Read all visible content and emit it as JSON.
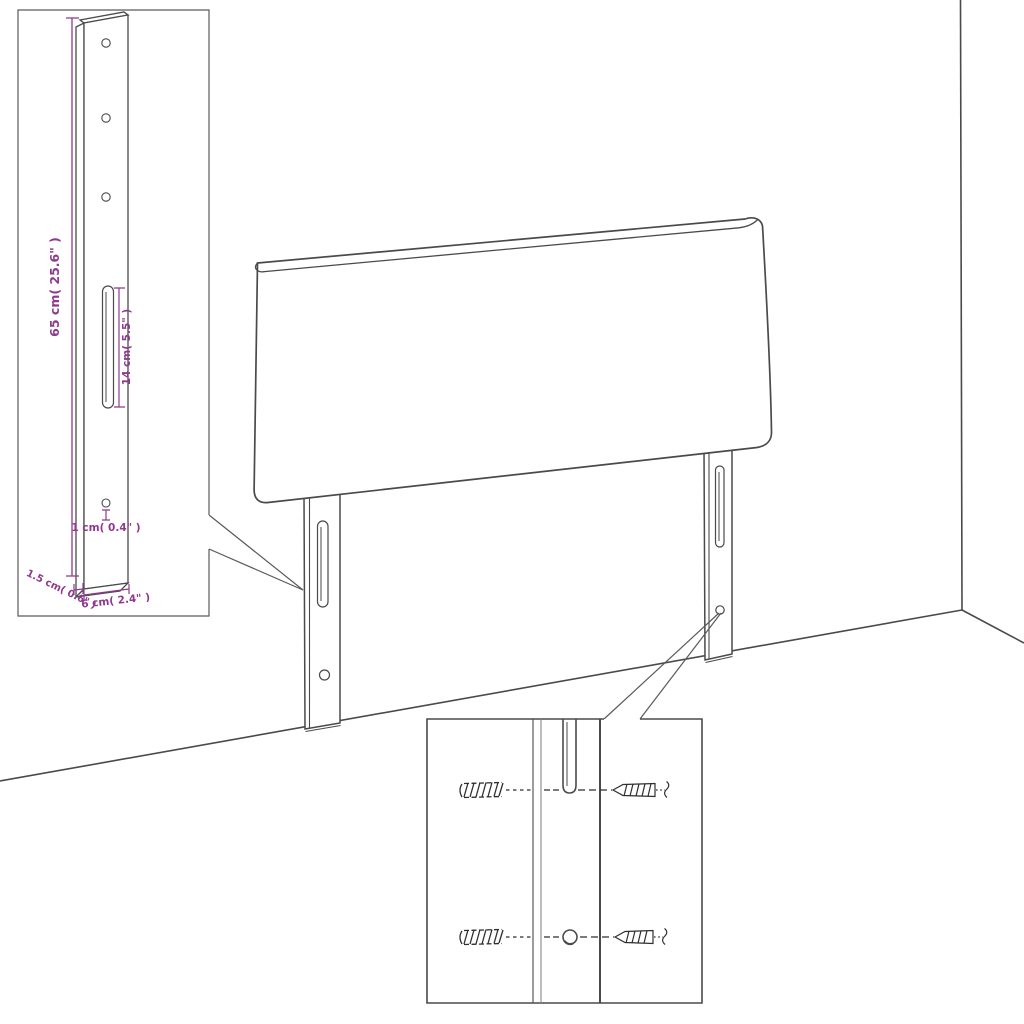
{
  "title": "Headboard dimension diagram",
  "diagram": {
    "kind": "product dimension line drawing",
    "background_color": "#ffffff",
    "line_color": "#4a4a4a",
    "dimension_color": "#8e3a8e"
  },
  "leg_detail_inset": {
    "labels": {
      "total_height": "65 cm( 25.6\" )",
      "slot_length": "14 cm( 5.5\" )",
      "hole_diameter": "1 cm( 0.4\" )",
      "leg_thickness": "1.5 cm( 0.6\" )",
      "leg_width": "6 cm( 2.4\" )"
    }
  },
  "mounting_inset": {
    "icons": [
      "wall-plug-icon",
      "screw-icon",
      "break-symbol-icon"
    ]
  }
}
